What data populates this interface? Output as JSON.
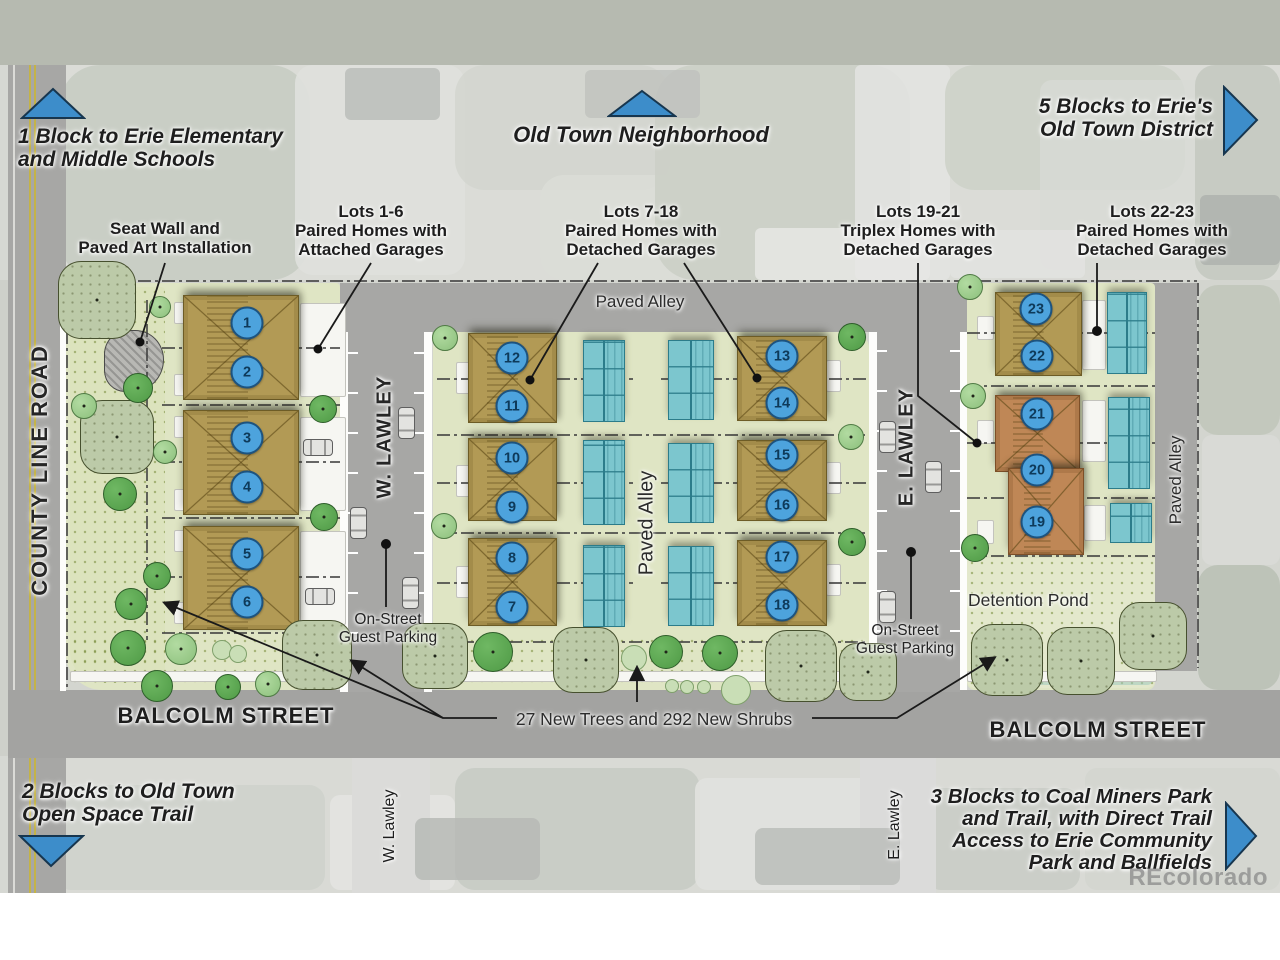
{
  "map": {
    "perimeter_labels": {
      "schools_line1": "1 Block to Erie Elementary",
      "schools_line2": "and Middle Schools",
      "old_town": "Old Town Neighborhood",
      "district_line1": "5 Blocks to Erie's",
      "district_line2": "Old Town District",
      "open_space_line1": "2 Blocks to Old Town",
      "open_space_line2": "Open Space Trail",
      "coal_line1": "3 Blocks to Coal Miners Park",
      "coal_line2": "and Trail, with Direct Trail",
      "coal_line3": "Access to Erie Community",
      "coal_line4": "Park and Ballfields"
    },
    "callouts": {
      "seat_wall_line1": "Seat Wall and",
      "seat_wall_line2": "Paved Art Installation",
      "lots16_line1": "Lots 1-6",
      "lots16_line2": "Paired Homes with",
      "lots16_line3": "Attached Garages",
      "lots718_line1": "Lots 7-18",
      "lots718_line2": "Paired Homes with",
      "lots718_line3": "Detached Garages",
      "lots1921_line1": "Lots 19-21",
      "lots1921_line2": "Triplex Homes with",
      "lots1921_line3": "Detached Garages",
      "lots2223_line1": "Lots 22-23",
      "lots2223_line2": "Paired Homes with",
      "lots2223_line3": "Detached Garages",
      "trees": "27 New Trees and 292 New Shrubs"
    },
    "streets": {
      "county_line": "COUNTY LINE ROAD",
      "w_lawley": "W. LAWLEY",
      "e_lawley": "E. LAWLEY",
      "balcolm_west": "BALCOLM STREET",
      "balcolm_east": "BALCOLM STREET",
      "w_lawley_south": "W. Lawley",
      "e_lawley_south": "E. Lawley",
      "paved_alley_north": "Paved Alley",
      "paved_alley_center": "Paved Alley",
      "paved_alley_east": "Paved Alley"
    },
    "notes": {
      "guest_parking_w_line1": "On-Street",
      "guest_parking_w_line2": "Guest Parking",
      "guest_parking_e_line1": "On-Street",
      "guest_parking_e_line2": "Guest Parking",
      "detention_pond": "Detention Pond"
    },
    "watermark": "REcolorado",
    "lots": [
      {
        "n": "1",
        "x": 247,
        "y": 323
      },
      {
        "n": "2",
        "x": 247,
        "y": 372
      },
      {
        "n": "3",
        "x": 247,
        "y": 438
      },
      {
        "n": "4",
        "x": 247,
        "y": 487
      },
      {
        "n": "5",
        "x": 247,
        "y": 554
      },
      {
        "n": "6",
        "x": 247,
        "y": 602
      },
      {
        "n": "7",
        "x": 512,
        "y": 607
      },
      {
        "n": "8",
        "x": 512,
        "y": 558
      },
      {
        "n": "9",
        "x": 512,
        "y": 507
      },
      {
        "n": "10",
        "x": 512,
        "y": 458
      },
      {
        "n": "11",
        "x": 512,
        "y": 406
      },
      {
        "n": "12",
        "x": 512,
        "y": 358
      },
      {
        "n": "13",
        "x": 782,
        "y": 356
      },
      {
        "n": "14",
        "x": 782,
        "y": 403
      },
      {
        "n": "15",
        "x": 782,
        "y": 455
      },
      {
        "n": "16",
        "x": 782,
        "y": 505
      },
      {
        "n": "17",
        "x": 782,
        "y": 557
      },
      {
        "n": "18",
        "x": 782,
        "y": 605
      },
      {
        "n": "19",
        "x": 1037,
        "y": 522
      },
      {
        "n": "20",
        "x": 1037,
        "y": 470
      },
      {
        "n": "21",
        "x": 1037,
        "y": 414
      },
      {
        "n": "22",
        "x": 1037,
        "y": 356
      },
      {
        "n": "23",
        "x": 1036,
        "y": 309
      }
    ],
    "colors": {
      "triangle_blue": "#3d8dca",
      "badge_blue": "#4da3dd",
      "home_tan": "#b29a55",
      "home_terracotta": "#bf8756",
      "garage_teal": "#7cc6ce",
      "plan_green": "#dfe5c4"
    }
  }
}
